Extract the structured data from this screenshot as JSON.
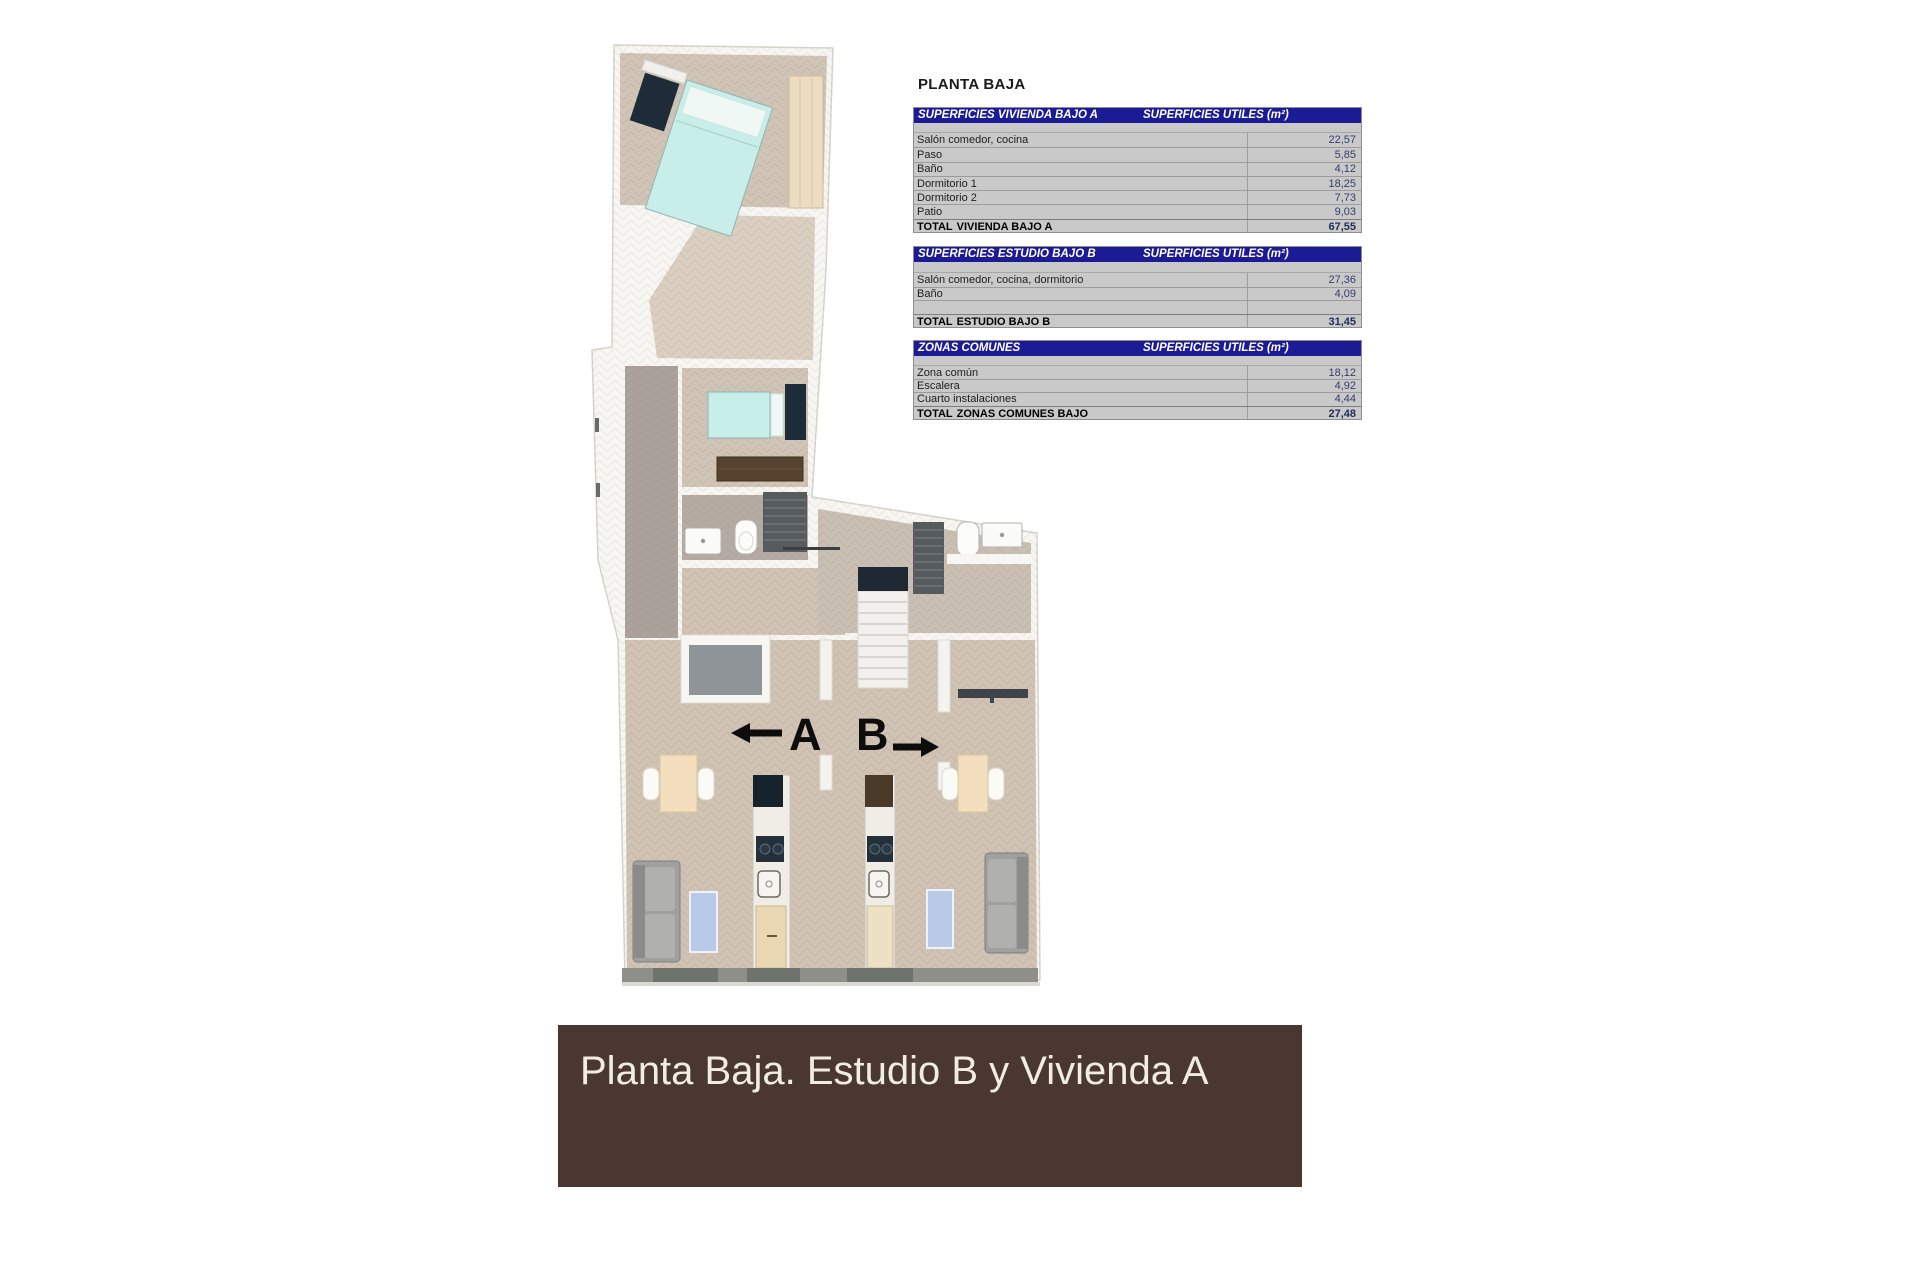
{
  "sheet": {
    "title": "PLANTA BAJA"
  },
  "colors": {
    "table_header_bg": "#1b1b96",
    "table_bg": "#c9c9c9",
    "value_text": "#333e6e",
    "banner_bg": "#4a3731",
    "banner_text": "#f2ede2"
  },
  "tables": [
    {
      "title": "SUPERFICIES VIVIENDA BAJO A",
      "units_header": "SUPERFICIES UTILES (m²)",
      "rows": [
        {
          "label": "Salón comedor, cocina",
          "value": "22,57"
        },
        {
          "label": "Paso",
          "value": "5,85"
        },
        {
          "label": "Baño",
          "value": "4,12"
        },
        {
          "label": "Dormitorio 1",
          "value": "18,25"
        },
        {
          "label": "Dormitorio 2",
          "value": "7,73"
        },
        {
          "label": "Patio",
          "value": "9,03"
        }
      ],
      "total": {
        "label_prefix": "TOTAL",
        "label_rest": "VIVIENDA BAJO A",
        "value": "67,55"
      }
    },
    {
      "title": "SUPERFICIES ESTUDIO BAJO B",
      "units_header": "SUPERFICIES UTILES (m²)",
      "rows": [
        {
          "label": "Salón comedor, cocina, dormitorio",
          "value": "27,36"
        },
        {
          "label": "Baño",
          "value": "4,09"
        },
        {
          "label": "",
          "value": ""
        }
      ],
      "total": {
        "label_prefix": "TOTAL",
        "label_rest": "ESTUDIO BAJO B",
        "value": "31,45"
      }
    },
    {
      "title": "ZONAS COMUNES",
      "units_header": "SUPERFICIES UTILES (m²)",
      "rows": [
        {
          "label": "Zona común",
          "value": "18,12"
        },
        {
          "label": "Escalera",
          "value": "4,92"
        },
        {
          "label": "Cuarto instalaciones",
          "value": "4,44"
        }
      ],
      "total": {
        "label_prefix": "TOTAL",
        "label_rest": "ZONAS COMUNES BAJO",
        "value": "27,48"
      }
    }
  ],
  "floorplan": {
    "unit_a_label": "A",
    "unit_b_label": "B"
  },
  "banner": {
    "text": "Planta Baja. Estudio B y Vivienda A"
  }
}
